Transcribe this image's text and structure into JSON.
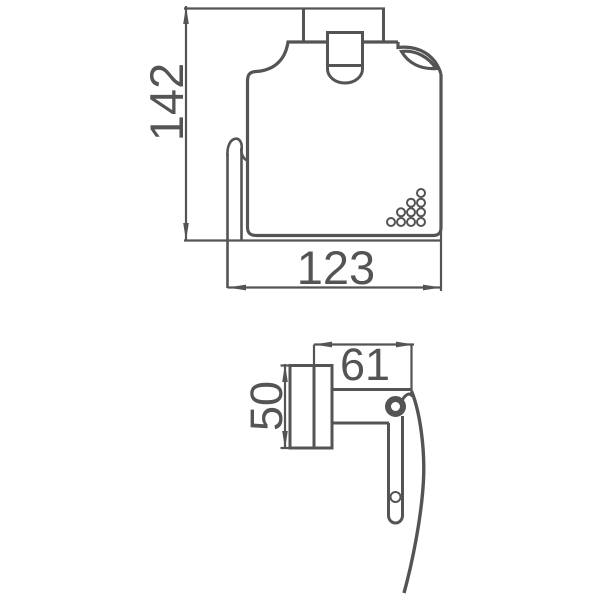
{
  "colors": {
    "background": "#ffffff",
    "line": "#545456"
  },
  "front_view": {
    "height_label": "142",
    "width_label": "123"
  },
  "side_view": {
    "width_label": "61",
    "height_label": "50"
  }
}
